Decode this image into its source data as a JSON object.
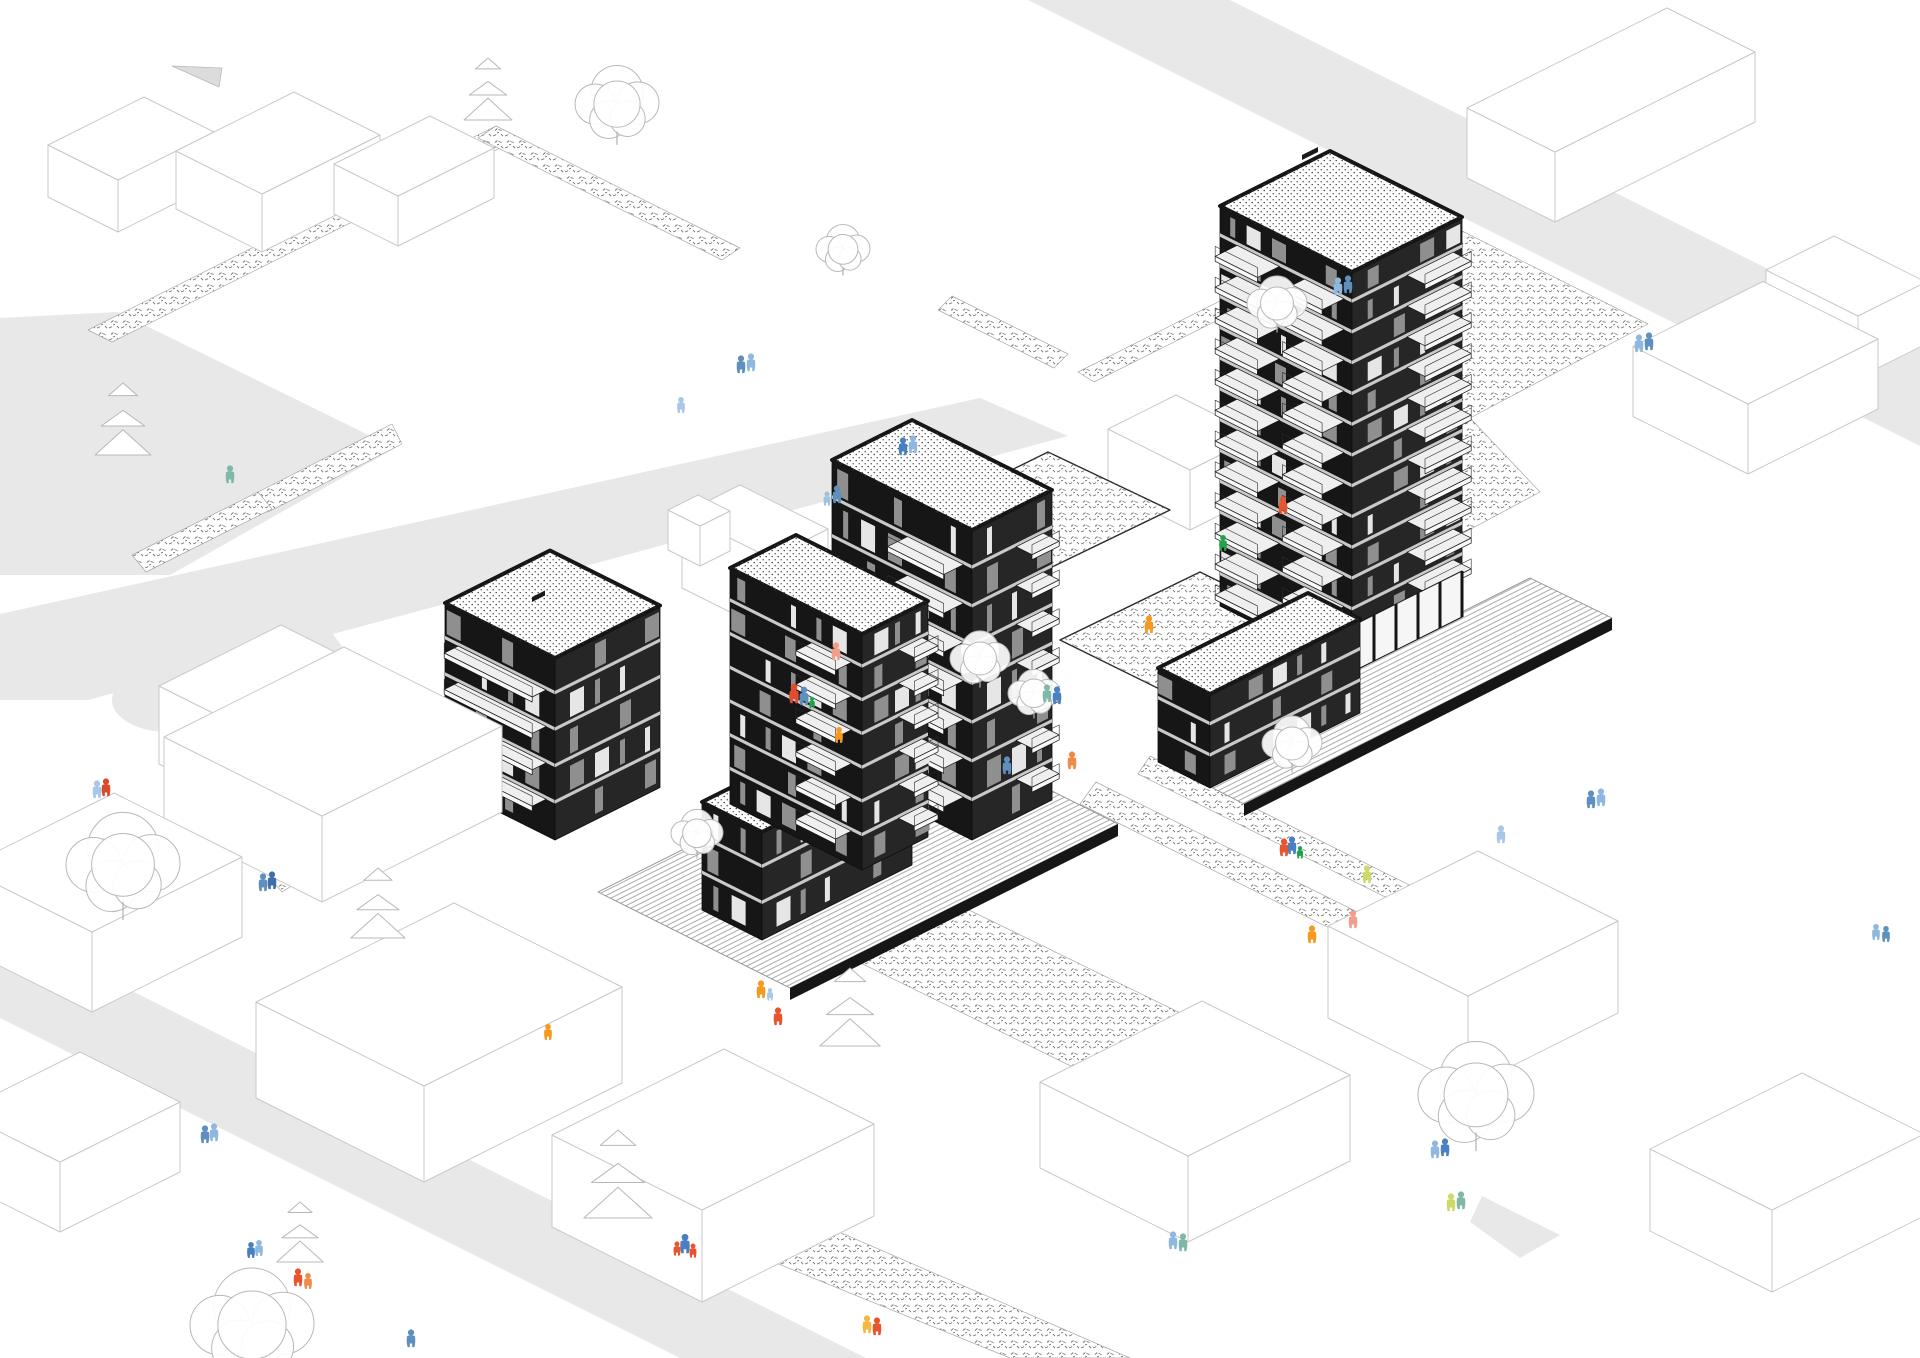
{
  "scene": {
    "type": "architectural-axonometric-site-illustration",
    "width": 1920,
    "height": 1358,
    "background": "#ffffff"
  },
  "palette": {
    "road": "#e8e8e8",
    "road_fragment": "#dcdcdc",
    "outline": "#c9c9c9",
    "ink": "#161616",
    "face_left": "#161616",
    "face_right": "#262626",
    "floor_band": "#c9c9c9",
    "window_light": "#e6e6e6",
    "window_grey": "#8f8f8f",
    "slab": "#efefef",
    "fascia": "#f8f8f8",
    "stipple": "#6e6e6e",
    "roof_dot": "#3a3a3a",
    "tree_stroke": "#b8b8b8",
    "deck_line": "#8f8f8f"
  },
  "roads": {
    "polygons": [
      {
        "name": "road-upper-left",
        "pts": [
          [
            0,
            318
          ],
          [
            118,
            312
          ],
          [
            395,
            448
          ],
          [
            170,
            575
          ],
          [
            0,
            575
          ]
        ]
      },
      {
        "name": "road-main-diagonal",
        "pts": [
          [
            0,
            614
          ],
          [
            980,
            398
          ],
          [
            1068,
            436
          ],
          [
            88,
            700
          ],
          [
            0,
            700
          ]
        ]
      },
      {
        "name": "road-culdesac-stub",
        "pts": [
          [
            190,
            664
          ],
          [
            330,
            630
          ],
          [
            352,
            660
          ],
          [
            212,
            698
          ]
        ]
      },
      {
        "name": "road-top-right",
        "pts": [
          [
            1028,
            0
          ],
          [
            1230,
            0
          ],
          [
            1920,
            345
          ],
          [
            1920,
            446
          ]
        ]
      },
      {
        "name": "road-bottom-left",
        "pts": [
          [
            0,
            925
          ],
          [
            866,
            1358
          ],
          [
            680,
            1358
          ],
          [
            0,
            1018
          ]
        ]
      },
      {
        "name": "road-fragment-top-left",
        "pts": [
          [
            172,
            66
          ],
          [
            222,
            68
          ],
          [
            219,
            87
          ]
        ]
      },
      {
        "name": "road-wedge-bottom-right",
        "pts": [
          [
            1482,
            1196
          ],
          [
            1560,
            1235
          ],
          [
            1520,
            1258
          ],
          [
            1470,
            1222
          ]
        ]
      }
    ],
    "circles": [
      {
        "name": "road-culdesac-loop",
        "cx": 168,
        "cy": 700,
        "rx": 56,
        "ry": 32
      }
    ]
  },
  "planting_strips": [
    {
      "name": "hedge-strip",
      "pts": [
        [
          88,
          330
        ],
        [
          496,
          126
        ],
        [
          520,
          138
        ],
        [
          112,
          342
        ]
      ]
    },
    {
      "name": "hedge-strip",
      "pts": [
        [
          496,
          126
        ],
        [
          740,
          248
        ],
        [
          722,
          260
        ],
        [
          478,
          138
        ]
      ]
    },
    {
      "name": "hedge-strip",
      "pts": [
        [
          392,
          424
        ],
        [
          258,
          492
        ],
        [
          268,
          512
        ],
        [
          402,
          444
        ]
      ]
    },
    {
      "name": "hedge-strip",
      "pts": [
        [
          258,
          492
        ],
        [
          132,
          555
        ],
        [
          146,
          572
        ],
        [
          272,
          509
        ]
      ]
    },
    {
      "name": "hedge-strip",
      "pts": [
        [
          243,
          806
        ],
        [
          342,
          854
        ],
        [
          330,
          868
        ],
        [
          231,
          820
        ]
      ]
    },
    {
      "name": "hedge-strip",
      "pts": [
        [
          342,
          854
        ],
        [
          282,
          892
        ],
        [
          270,
          878
        ],
        [
          330,
          840
        ]
      ]
    },
    {
      "name": "hedge-strip",
      "pts": [
        [
          952,
          296
        ],
        [
          1068,
          354
        ],
        [
          1054,
          368
        ],
        [
          938,
          310
        ]
      ]
    },
    {
      "name": "hedge-strip",
      "pts": [
        [
          1078,
          372
        ],
        [
          1298,
          262
        ],
        [
          1314,
          272
        ],
        [
          1094,
          382
        ]
      ]
    },
    {
      "name": "stipple-field-east",
      "pts": [
        [
          1312,
          270
        ],
        [
          1428,
          214
        ],
        [
          1648,
          324
        ],
        [
          1470,
          418
        ],
        [
          1540,
          492
        ],
        [
          1428,
          552
        ],
        [
          1300,
          420
        ]
      ]
    },
    {
      "name": "stipple-walk",
      "pts": [
        [
          1150,
          756
        ],
        [
          1536,
          948
        ],
        [
          1524,
          966
        ],
        [
          1138,
          774
        ]
      ]
    },
    {
      "name": "stipple-walk",
      "pts": [
        [
          1096,
          782
        ],
        [
          1478,
          972
        ],
        [
          1462,
          994
        ],
        [
          1080,
          804
        ]
      ]
    },
    {
      "name": "stipple-patch",
      "pts": [
        [
          826,
          946
        ],
        [
          932,
          892
        ],
        [
          1240,
          1042
        ],
        [
          1136,
          1098
        ]
      ]
    },
    {
      "name": "stipple-patch",
      "pts": [
        [
          756,
          1196
        ],
        [
          1130,
          1358
        ],
        [
          1010,
          1358
        ],
        [
          744,
          1250
        ]
      ]
    },
    {
      "name": "stipple-patch",
      "pts": [
        [
          418,
          750
        ],
        [
          506,
          706
        ],
        [
          592,
          750
        ],
        [
          506,
          794
        ]
      ]
    }
  ],
  "courtyards": [
    {
      "name": "upper-courtyard",
      "pts": [
        [
          930,
          510
        ],
        [
          1048,
          452
        ],
        [
          1170,
          510
        ],
        [
          1050,
          568
        ]
      ]
    },
    {
      "name": "podium-courtyard",
      "pts": [
        [
          1060,
          640
        ],
        [
          1200,
          572
        ],
        [
          1330,
          636
        ],
        [
          1190,
          704
        ]
      ]
    }
  ],
  "ramps": [
    {
      "name": "access-ramp",
      "pts": [
        [
          812,
          716
        ],
        [
          958,
          788
        ],
        [
          918,
          812
        ],
        [
          788,
          738
        ]
      ]
    }
  ],
  "decks": [
    {
      "name": "timber-deck-west",
      "pts": [
        [
          598,
          892
        ],
        [
          926,
          728
        ],
        [
          1118,
          824
        ],
        [
          790,
          988
        ]
      ]
    },
    {
      "name": "timber-deck-east",
      "pts": [
        [
          1162,
          762
        ],
        [
          1530,
          578
        ],
        [
          1612,
          618
        ],
        [
          1244,
          804
        ]
      ]
    }
  ],
  "deck_edges": [
    {
      "pts": [
        [
          790,
          988
        ],
        [
          1118,
          824
        ],
        [
          1118,
          836
        ],
        [
          790,
          1000
        ]
      ]
    },
    {
      "pts": [
        [
          1244,
          804
        ],
        [
          1612,
          618
        ],
        [
          1612,
          630
        ],
        [
          1244,
          816
        ]
      ]
    }
  ],
  "context_buildings_back": [
    {
      "x": 118,
      "y": 232,
      "la": 96,
      "lb": 70,
      "h": 52
    },
    {
      "x": 262,
      "y": 252,
      "la": 118,
      "lb": 86,
      "h": 58
    },
    {
      "x": 398,
      "y": 246,
      "la": 96,
      "lb": 64,
      "h": 50
    },
    {
      "x": 770,
      "y": 632,
      "la": 58,
      "lb": 88,
      "h": 74
    },
    {
      "x": 700,
      "y": 566,
      "la": 30,
      "lb": 32,
      "h": 40
    },
    {
      "x": 1190,
      "y": 530,
      "la": 68,
      "lb": 82,
      "h": 60
    },
    {
      "x": 1555,
      "y": 222,
      "la": 200,
      "lb": 88,
      "h": 70
    },
    {
      "x": 1858,
      "y": 378,
      "la": 68,
      "lb": 92,
      "h": 62
    },
    {
      "x": 1748,
      "y": 474,
      "la": 130,
      "lb": 115,
      "h": 70
    }
  ],
  "context_buildings_front": [
    {
      "x": 255,
      "y": 812,
      "la": 122,
      "lb": 96,
      "h": 78
    },
    {
      "x": 322,
      "y": 902,
      "la": 180,
      "lb": 158,
      "h": 86
    },
    {
      "x": 92,
      "y": 1012,
      "la": 150,
      "lb": 128,
      "h": 80
    },
    {
      "x": 424,
      "y": 1182,
      "la": 198,
      "lb": 168,
      "h": 96
    },
    {
      "x": 702,
      "y": 1302,
      "la": 172,
      "lb": 150,
      "h": 92
    },
    {
      "x": 1468,
      "y": 1088,
      "la": 150,
      "lb": 140,
      "h": 92
    },
    {
      "x": 1188,
      "y": 1242,
      "la": 162,
      "lb": 148,
      "h": 86
    },
    {
      "x": 1772,
      "y": 1292,
      "la": 152,
      "lb": 122,
      "h": 82
    },
    {
      "x": 60,
      "y": 1232,
      "la": 120,
      "lb": 100,
      "h": 70
    }
  ],
  "buildings": [
    {
      "name": "building-centre-tower",
      "x": 972,
      "y": 840,
      "la": 80,
      "lb": 140,
      "h": 310,
      "floors": 8,
      "balconies": [
        {
          "face": "L",
          "off": 0.06,
          "w": 0.4,
          "f0": 1,
          "f1": 7,
          "d": 20
        },
        {
          "face": "R",
          "off": 0.55,
          "w": 0.34,
          "f0": 1,
          "f1": 7,
          "d": 16
        }
      ],
      "colonnade": false,
      "vent": null
    },
    {
      "name": "building-main-tower",
      "x": 1352,
      "y": 672,
      "la": 110,
      "lb": 132,
      "h": 400,
      "floors": 13,
      "balconies": [
        {
          "face": "L",
          "off": 0.06,
          "w": 0.3,
          "f0": 1,
          "f1": 12,
          "d": 22
        },
        {
          "face": "L",
          "off": 0.55,
          "w": 0.32,
          "f0": 1,
          "f1": 12,
          "d": 22
        },
        {
          "face": "R",
          "off": 0.5,
          "w": 0.42,
          "f0": 2,
          "f1": 12,
          "d": 18
        }
      ],
      "colonnade": true,
      "vent": {
        "x": 1302,
        "y": 160,
        "w": 16
      }
    },
    {
      "name": "building-east-wing",
      "x": 1210,
      "y": 788,
      "la": 150,
      "lb": 52,
      "h": 94,
      "floors": 3,
      "balconies": [],
      "colonnade": false,
      "vent": null
    },
    {
      "name": "building-west-block",
      "x": 555,
      "y": 840,
      "la": 105,
      "lb": 110,
      "h": 182,
      "floors": 5,
      "balconies": [
        {
          "face": "L",
          "off": 0.08,
          "w": 0.8,
          "f0": 1,
          "f1": 4,
          "d": 14
        }
      ],
      "colonnade": false,
      "vent": {
        "x": 532,
        "y": 602,
        "w": 13
      }
    },
    {
      "name": "building-west-wing",
      "x": 762,
      "y": 940,
      "la": 150,
      "lb": 60,
      "h": 108,
      "floors": 3,
      "balconies": [],
      "colonnade": false,
      "vent": null
    },
    {
      "name": "building-front-block",
      "x": 862,
      "y": 870,
      "la": 66,
      "lb": 132,
      "h": 236,
      "floors": 7,
      "balconies": [
        {
          "face": "L",
          "off": 0.08,
          "w": 0.3,
          "f0": 1,
          "f1": 6,
          "d": 16
        },
        {
          "face": "R",
          "off": 0.55,
          "w": 0.36,
          "f0": 1,
          "f1": 6,
          "d": 16
        }
      ],
      "colonnade": false,
      "vent": null
    }
  ],
  "trees": [
    {
      "type": "canopy",
      "x": 617,
      "y": 102,
      "r": 42
    },
    {
      "type": "canopy",
      "x": 843,
      "y": 248,
      "r": 27
    },
    {
      "type": "canopy",
      "x": 1277,
      "y": 302,
      "r": 30
    },
    {
      "type": "canopy",
      "x": 123,
      "y": 862,
      "r": 57
    },
    {
      "type": "canopy",
      "x": 252,
      "y": 1322,
      "r": 62
    },
    {
      "type": "canopy",
      "x": 980,
      "y": 657,
      "r": 30
    },
    {
      "type": "canopy",
      "x": 1034,
      "y": 692,
      "r": 26
    },
    {
      "type": "canopy",
      "x": 1292,
      "y": 742,
      "r": 30
    },
    {
      "type": "canopy",
      "x": 1476,
      "y": 1092,
      "r": 58
    },
    {
      "type": "canopy",
      "x": 697,
      "y": 832,
      "r": 26
    },
    {
      "type": "pine",
      "x": 488,
      "y": 120,
      "r": 62
    },
    {
      "type": "pine",
      "x": 123,
      "y": 455,
      "r": 72
    },
    {
      "type": "pine",
      "x": 850,
      "y": 1046,
      "r": 78
    },
    {
      "type": "pine",
      "x": 618,
      "y": 1218,
      "r": 88
    },
    {
      "type": "pine",
      "x": 378,
      "y": 938,
      "r": 70
    },
    {
      "type": "pine",
      "x": 300,
      "y": 1262,
      "r": 60
    }
  ],
  "people": [
    {
      "x": 741,
      "y": 371,
      "c": "#5E8FBF",
      "s": 1
    },
    {
      "x": 751,
      "y": 369,
      "c": "#8FB8E0",
      "s": 1
    },
    {
      "x": 681,
      "y": 411,
      "c": "#A9C7E8",
      "s": 0.9
    },
    {
      "x": 903,
      "y": 453,
      "c": "#4A7FC1",
      "s": 1
    },
    {
      "x": 913,
      "y": 451,
      "c": "#8FB8E0",
      "s": 1
    },
    {
      "x": 827,
      "y": 504,
      "c": "#9FC2E0",
      "s": 0.8
    },
    {
      "x": 837,
      "y": 501,
      "c": "#5E8FBF",
      "s": 1
    },
    {
      "x": 836,
      "y": 658,
      "c": "#F29E8A",
      "s": 1
    },
    {
      "x": 794,
      "y": 701,
      "c": "#E14B32",
      "s": 1.1
    },
    {
      "x": 804,
      "y": 703,
      "c": "#5E8FBF",
      "s": 1.05
    },
    {
      "x": 812,
      "y": 707,
      "c": "#22A04A",
      "s": 0.65
    },
    {
      "x": 839,
      "y": 741,
      "c": "#F5991F",
      "s": 0.9
    },
    {
      "x": 230,
      "y": 481,
      "c": "#7FB8A8",
      "s": 1
    },
    {
      "x": 97,
      "y": 796,
      "c": "#A9C7E8",
      "s": 1
    },
    {
      "x": 106,
      "y": 794,
      "c": "#D94A2B",
      "s": 1
    },
    {
      "x": 263,
      "y": 889,
      "c": "#5E8FBF",
      "s": 1
    },
    {
      "x": 272,
      "y": 887,
      "c": "#3F6FA8",
      "s": 1
    },
    {
      "x": 1338,
      "y": 293,
      "c": "#8FB8E0",
      "s": 1
    },
    {
      "x": 1348,
      "y": 291,
      "c": "#5E8FBF",
      "s": 1
    },
    {
      "x": 1639,
      "y": 350,
      "c": "#8FB8E0",
      "s": 1
    },
    {
      "x": 1649,
      "y": 348,
      "c": "#5E8FBF",
      "s": 1
    },
    {
      "x": 1283,
      "y": 512,
      "c": "#E8542E",
      "s": 1
    },
    {
      "x": 1223,
      "y": 549,
      "c": "#22A04A",
      "s": 0.9
    },
    {
      "x": 1149,
      "y": 631,
      "c": "#F5991F",
      "s": 1
    },
    {
      "x": 1047,
      "y": 700,
      "c": "#7FB8A8",
      "s": 1
    },
    {
      "x": 1057,
      "y": 702,
      "c": "#4A7FC1",
      "s": 1
    },
    {
      "x": 1007,
      "y": 772,
      "c": "#5E8FBF",
      "s": 1
    },
    {
      "x": 1072,
      "y": 767,
      "c": "#F08A45",
      "s": 1
    },
    {
      "x": 761,
      "y": 996,
      "c": "#F5991F",
      "s": 1
    },
    {
      "x": 770,
      "y": 999,
      "c": "#A9C7E8",
      "s": 0.7
    },
    {
      "x": 778,
      "y": 1023,
      "c": "#E8542E",
      "s": 1
    },
    {
      "x": 677,
      "y": 1254,
      "c": "#E8542E",
      "s": 0.8
    },
    {
      "x": 685,
      "y": 1251,
      "c": "#4A7FC1",
      "s": 1.1
    },
    {
      "x": 693,
      "y": 1256,
      "c": "#E8542E",
      "s": 0.8
    },
    {
      "x": 548,
      "y": 1038,
      "c": "#F5991F",
      "s": 0.9
    },
    {
      "x": 1284,
      "y": 854,
      "c": "#E8542E",
      "s": 1
    },
    {
      "x": 1292,
      "y": 852,
      "c": "#4A7FC1",
      "s": 1
    },
    {
      "x": 1300,
      "y": 857,
      "c": "#22A04A",
      "s": 0.7
    },
    {
      "x": 1367,
      "y": 881,
      "c": "#CFD96A",
      "s": 1
    },
    {
      "x": 1353,
      "y": 926,
      "c": "#F29E8A",
      "s": 1
    },
    {
      "x": 1312,
      "y": 941,
      "c": "#F5991F",
      "s": 1
    },
    {
      "x": 1435,
      "y": 1156,
      "c": "#8FB8E0",
      "s": 1
    },
    {
      "x": 1445,
      "y": 1154,
      "c": "#4A7FC1",
      "s": 1
    },
    {
      "x": 1451,
      "y": 1209,
      "c": "#CFD96A",
      "s": 1
    },
    {
      "x": 1461,
      "y": 1207,
      "c": "#7FB8A8",
      "s": 1
    },
    {
      "x": 1173,
      "y": 1247,
      "c": "#8FB8E0",
      "s": 1
    },
    {
      "x": 1183,
      "y": 1249,
      "c": "#7FB8A8",
      "s": 1
    },
    {
      "x": 205,
      "y": 1141,
      "c": "#5E8FBF",
      "s": 1
    },
    {
      "x": 214,
      "y": 1139,
      "c": "#8FB8E0",
      "s": 1
    },
    {
      "x": 251,
      "y": 1256,
      "c": "#4A7FC1",
      "s": 0.9
    },
    {
      "x": 259,
      "y": 1254,
      "c": "#8FB8E0",
      "s": 0.9
    },
    {
      "x": 298,
      "y": 1284,
      "c": "#E8542E",
      "s": 1
    },
    {
      "x": 308,
      "y": 1287,
      "c": "#F08A45",
      "s": 0.9
    },
    {
      "x": 411,
      "y": 1345,
      "c": "#5E8FBF",
      "s": 1
    },
    {
      "x": 867,
      "y": 1331,
      "c": "#F5B73F",
      "s": 1
    },
    {
      "x": 877,
      "y": 1333,
      "c": "#E8542E",
      "s": 1
    },
    {
      "x": 1591,
      "y": 806,
      "c": "#5E8FBF",
      "s": 1
    },
    {
      "x": 1601,
      "y": 804,
      "c": "#8FB8E0",
      "s": 1
    },
    {
      "x": 1501,
      "y": 841,
      "c": "#A9C7E8",
      "s": 1
    },
    {
      "x": 1876,
      "y": 938,
      "c": "#8FB8E0",
      "s": 0.9
    },
    {
      "x": 1886,
      "y": 940,
      "c": "#5E8FBF",
      "s": 0.9
    }
  ]
}
